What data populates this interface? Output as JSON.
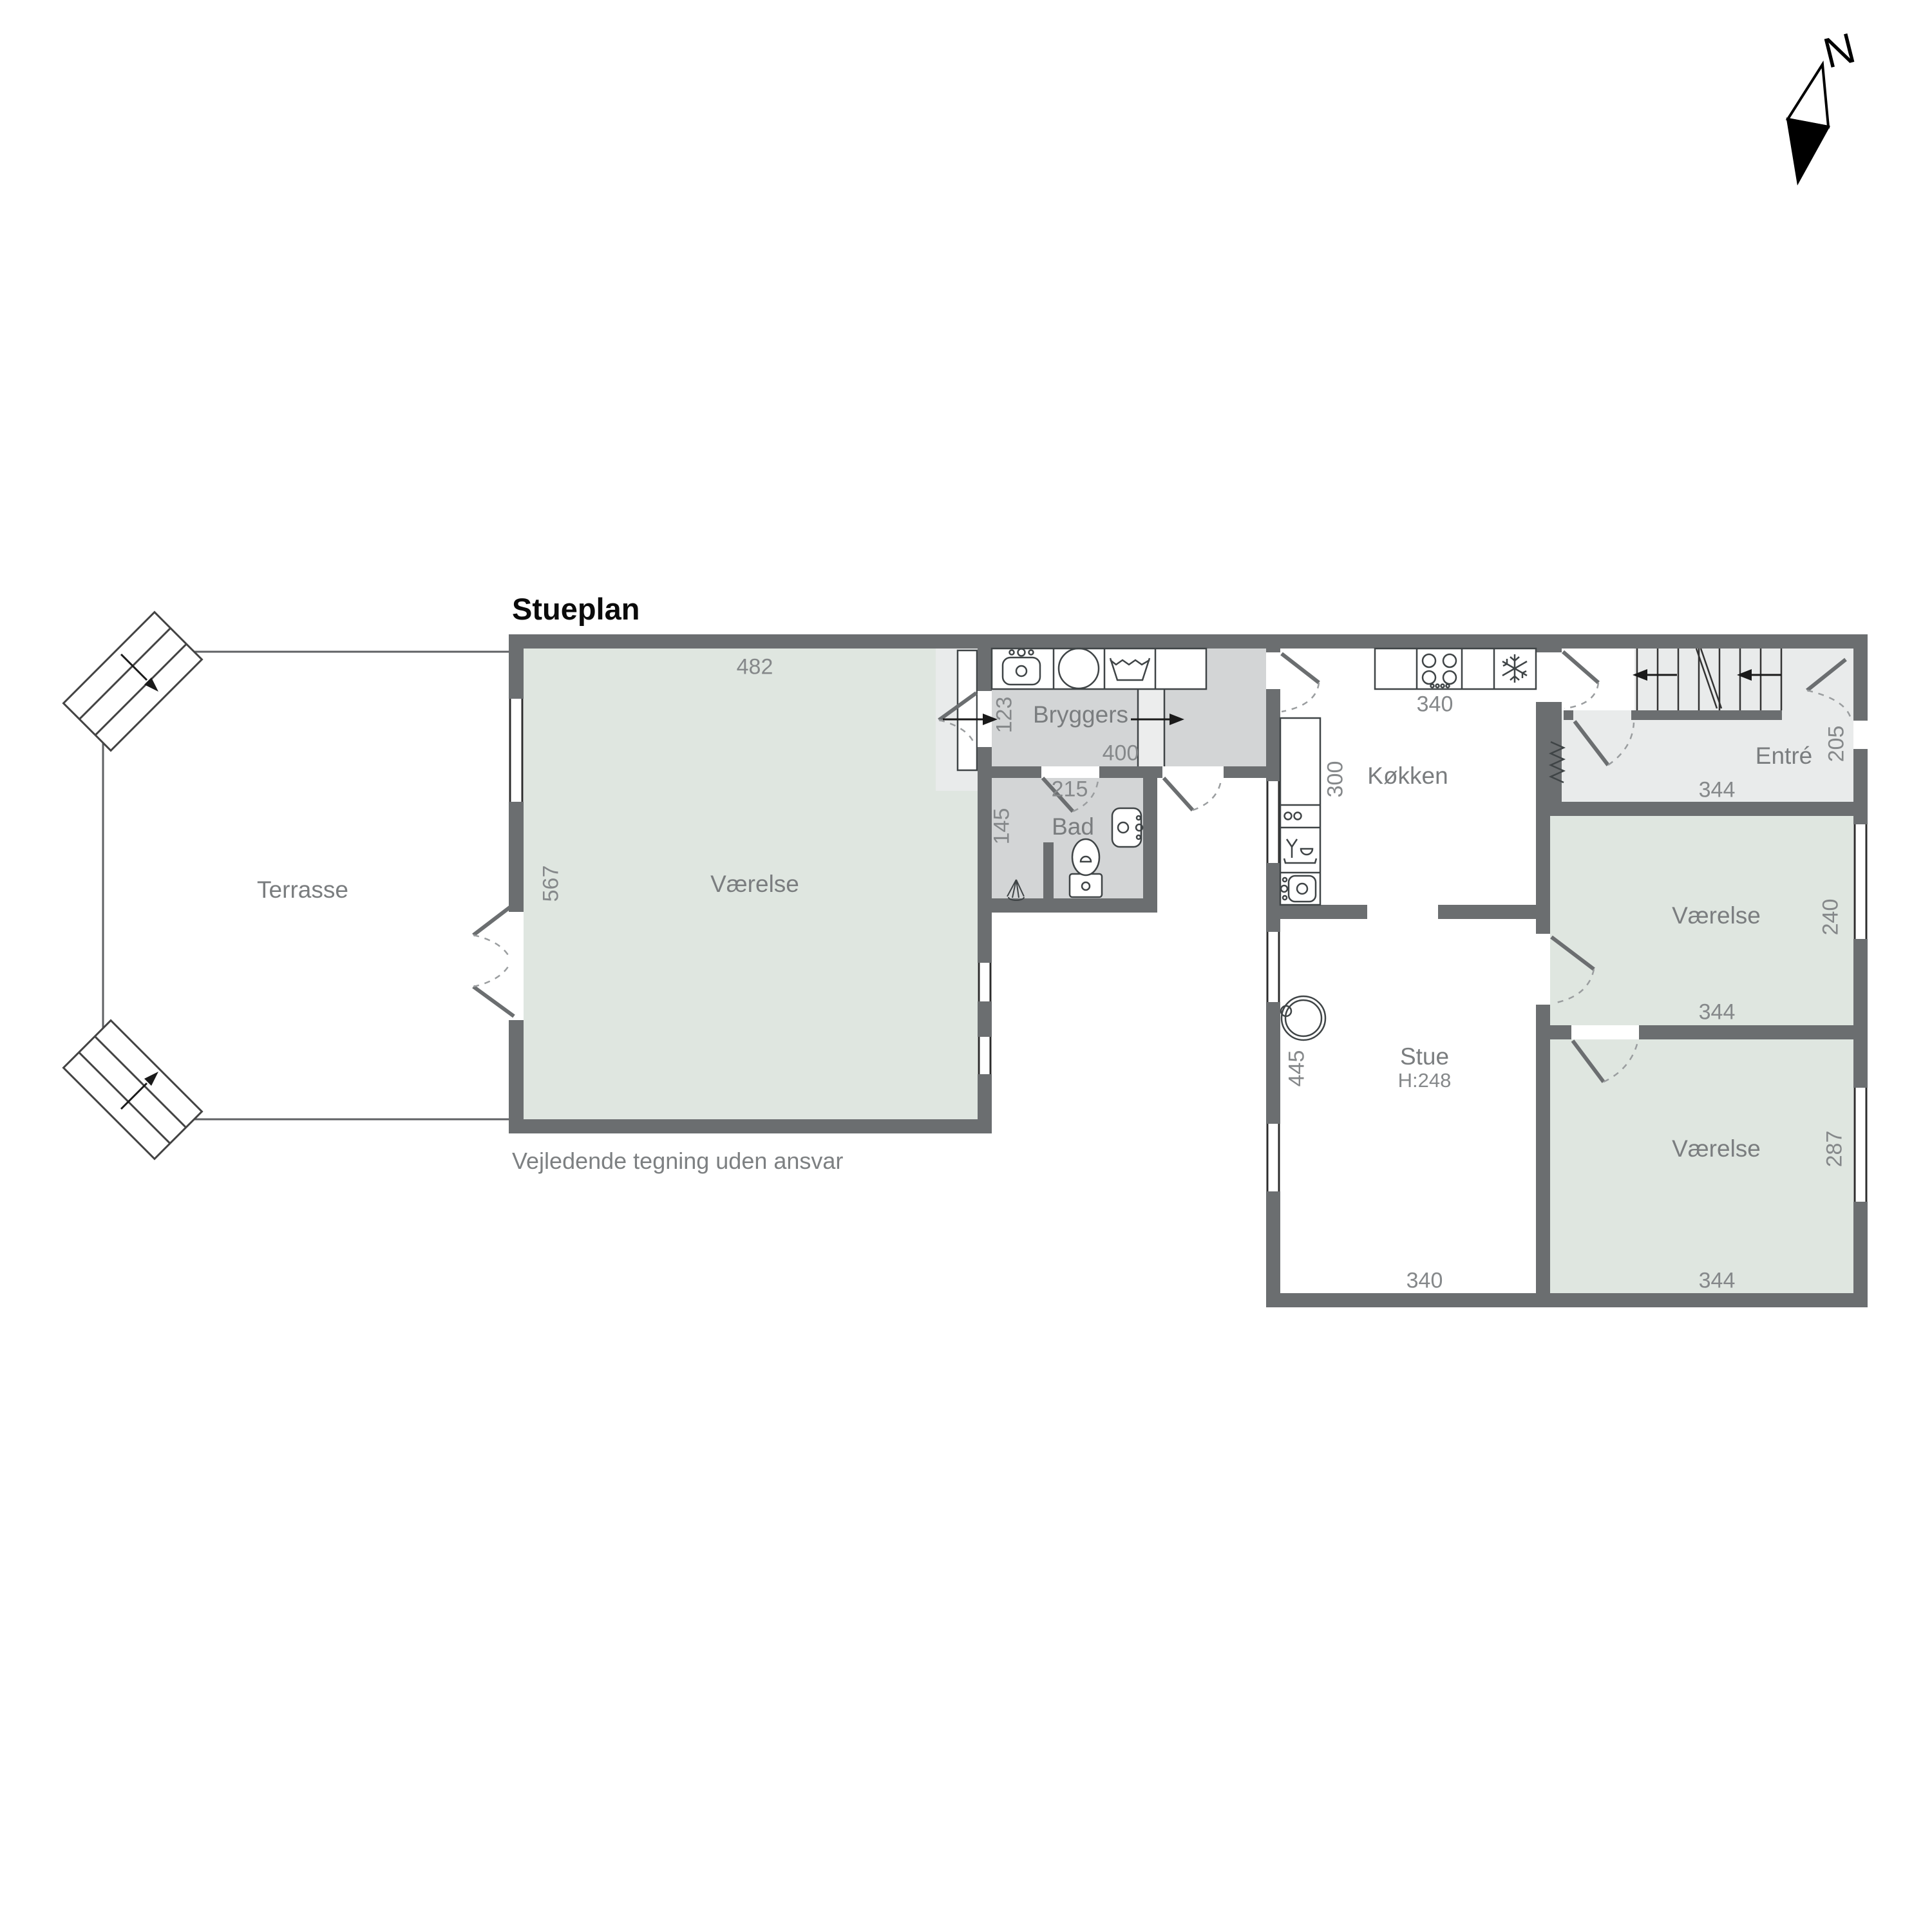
{
  "title": "Stueplan",
  "disclaimer": "Vejledende tegning uden ansvar",
  "compass": {
    "label": "N"
  },
  "colors": {
    "wall": "#6b6e70",
    "room_green": "#dfe6e0",
    "room_grey": "#d3d5d6",
    "room_light": "#e9ebeb",
    "fixture_line": "#3f4446",
    "label_text": "#7a7d7f",
    "dim_text": "#85888a"
  },
  "rooms": {
    "terrasse": {
      "label": "Terrasse"
    },
    "vaerelse_left": {
      "label": "Værelse",
      "dim_top": "482",
      "dim_left": "567"
    },
    "bryggers": {
      "label": "Bryggers",
      "dim_left": "123",
      "dim_bottom": "400"
    },
    "bad": {
      "label": "Bad",
      "dim_top": "215",
      "dim_left": "145"
    },
    "koekken": {
      "label": "Køkken",
      "dim_top": "340",
      "dim_left": "300"
    },
    "entre": {
      "label": "Entré",
      "dim_right": "205",
      "dim_bottom": "344"
    },
    "stue": {
      "label": "Stue",
      "ceiling_height": "H:248",
      "dim_left": "445",
      "dim_bottom": "340"
    },
    "vaerelse_ne": {
      "label": "Værelse",
      "dim_right": "240",
      "dim_bottom": "344"
    },
    "vaerelse_se": {
      "label": "Værelse",
      "dim_right": "287",
      "dim_bottom": "344"
    }
  }
}
